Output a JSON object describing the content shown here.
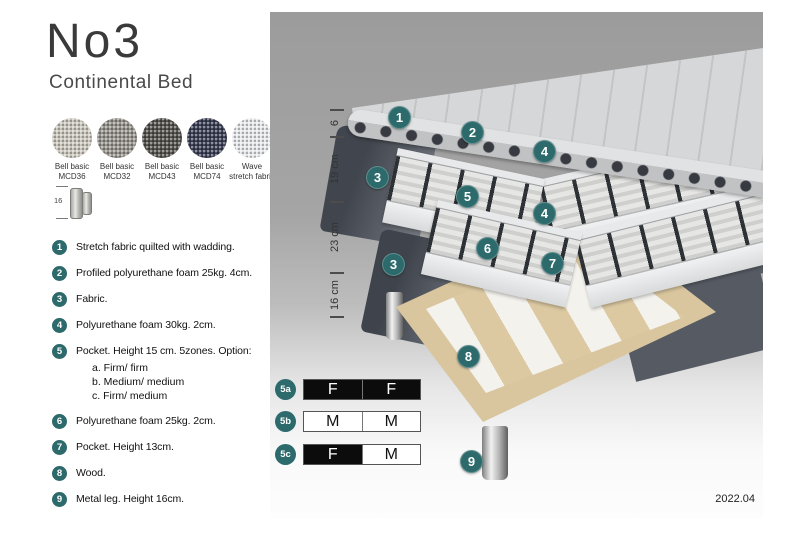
{
  "header": {
    "title": "No3",
    "subtitle": "Continental Bed"
  },
  "swatches": [
    {
      "name": "Bell basic",
      "code": "MCD36",
      "color": "#cdc9bf"
    },
    {
      "name": "Bell basic",
      "code": "MCD32",
      "color": "#97948e"
    },
    {
      "name": "Bell basic",
      "code": "MCD43",
      "color": "#53514c"
    },
    {
      "name": "Bell basic",
      "code": "MCD74",
      "color": "#393d53"
    },
    {
      "name": "Wave",
      "code": "stretch fabric",
      "color": "#e9ebee"
    }
  ],
  "leg_figure": {
    "height_label": "16"
  },
  "legend": [
    {
      "num": "1",
      "text": "Stretch fabric quilted with wadding."
    },
    {
      "num": "2",
      "text": "Profiled polyurethane foam 25kg. 4cm."
    },
    {
      "num": "3",
      "text": "Fabric."
    },
    {
      "num": "4",
      "text": "Polyurethane foam 30kg. 2cm."
    },
    {
      "num": "5",
      "text": "Pocket. Height 15 cm. 5zones. Option:",
      "options": [
        "a. Firm/ firm",
        "b. Medium/ medium",
        "c. Firm/ medium"
      ]
    },
    {
      "num": "6",
      "text": "Polyurethane foam 25kg. 2cm."
    },
    {
      "num": "7",
      "text": "Pocket. Height 13cm."
    },
    {
      "num": "8",
      "text": "Wood."
    },
    {
      "num": "9",
      "text": "Metal leg. Height 16cm."
    }
  ],
  "diagram": {
    "dimensions": [
      {
        "label": "6"
      },
      {
        "label": "19 cm"
      },
      {
        "label": "23 cm"
      },
      {
        "label": "16 cm"
      }
    ],
    "callouts": [
      {
        "label": "1"
      },
      {
        "label": "2"
      },
      {
        "label": "4"
      },
      {
        "label": "3"
      },
      {
        "label": "5"
      },
      {
        "label": "4"
      },
      {
        "label": "6"
      },
      {
        "label": "7"
      },
      {
        "label": "3"
      },
      {
        "label": "8"
      },
      {
        "label": "9"
      }
    ],
    "date": "2022.04"
  },
  "firmness": {
    "rows": [
      {
        "label": "5a",
        "cells": [
          {
            "text": "F",
            "filled": true
          },
          {
            "text": "F",
            "filled": true
          }
        ]
      },
      {
        "label": "5b",
        "cells": [
          {
            "text": "M",
            "filled": false
          },
          {
            "text": "M",
            "filled": false
          }
        ]
      },
      {
        "label": "5c",
        "cells": [
          {
            "text": "F",
            "filled": true
          },
          {
            "text": "M",
            "filled": false
          }
        ]
      }
    ]
  },
  "colors": {
    "accent_teal": "#2d6a6c",
    "fabric_dark": "#51565e",
    "wood": "#dcc7a0",
    "metal_leg": "#c0c0c0"
  }
}
